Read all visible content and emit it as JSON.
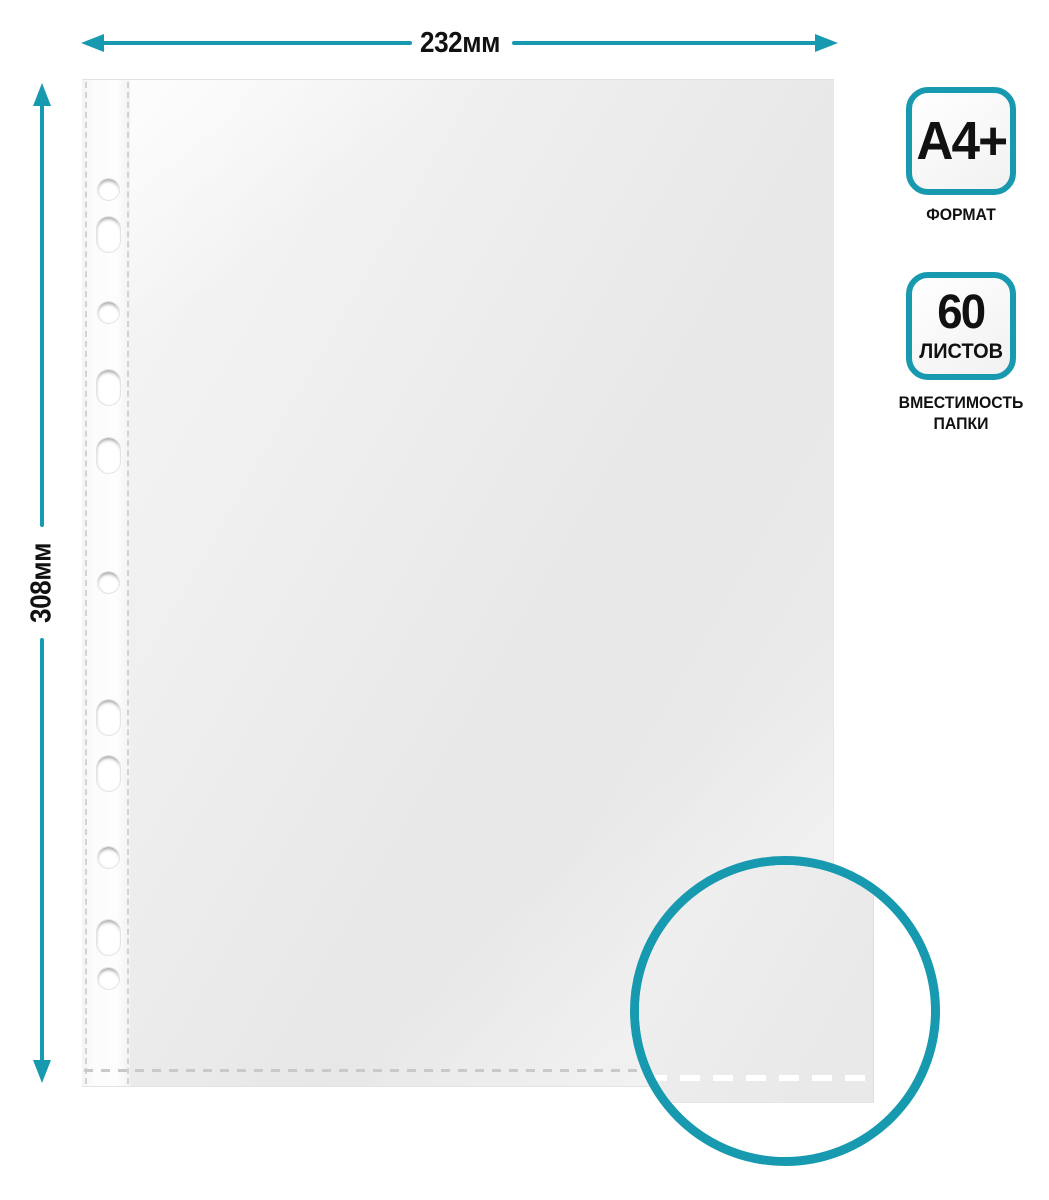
{
  "accent_color": "#1799af",
  "dimensions": {
    "width_label": "232мм",
    "height_label": "308мм"
  },
  "badges": {
    "format": {
      "value": "A4+",
      "caption": "ФОРМАТ"
    },
    "capacity": {
      "value": "60",
      "unit": "ЛИСТОВ",
      "caption_line1": "ВМЕСТИМОСТЬ",
      "caption_line2": "ПАПКИ"
    }
  },
  "sheet": {
    "holes": [
      {
        "type": "round",
        "y": 188
      },
      {
        "type": "oval",
        "y": 233
      },
      {
        "type": "round",
        "y": 311
      },
      {
        "type": "oval",
        "y": 386
      },
      {
        "type": "oval",
        "y": 454
      },
      {
        "type": "round",
        "y": 581
      },
      {
        "type": "oval",
        "y": 716
      },
      {
        "type": "oval",
        "y": 772
      },
      {
        "type": "round",
        "y": 856
      },
      {
        "type": "oval",
        "y": 936
      },
      {
        "type": "round",
        "y": 977
      }
    ]
  }
}
